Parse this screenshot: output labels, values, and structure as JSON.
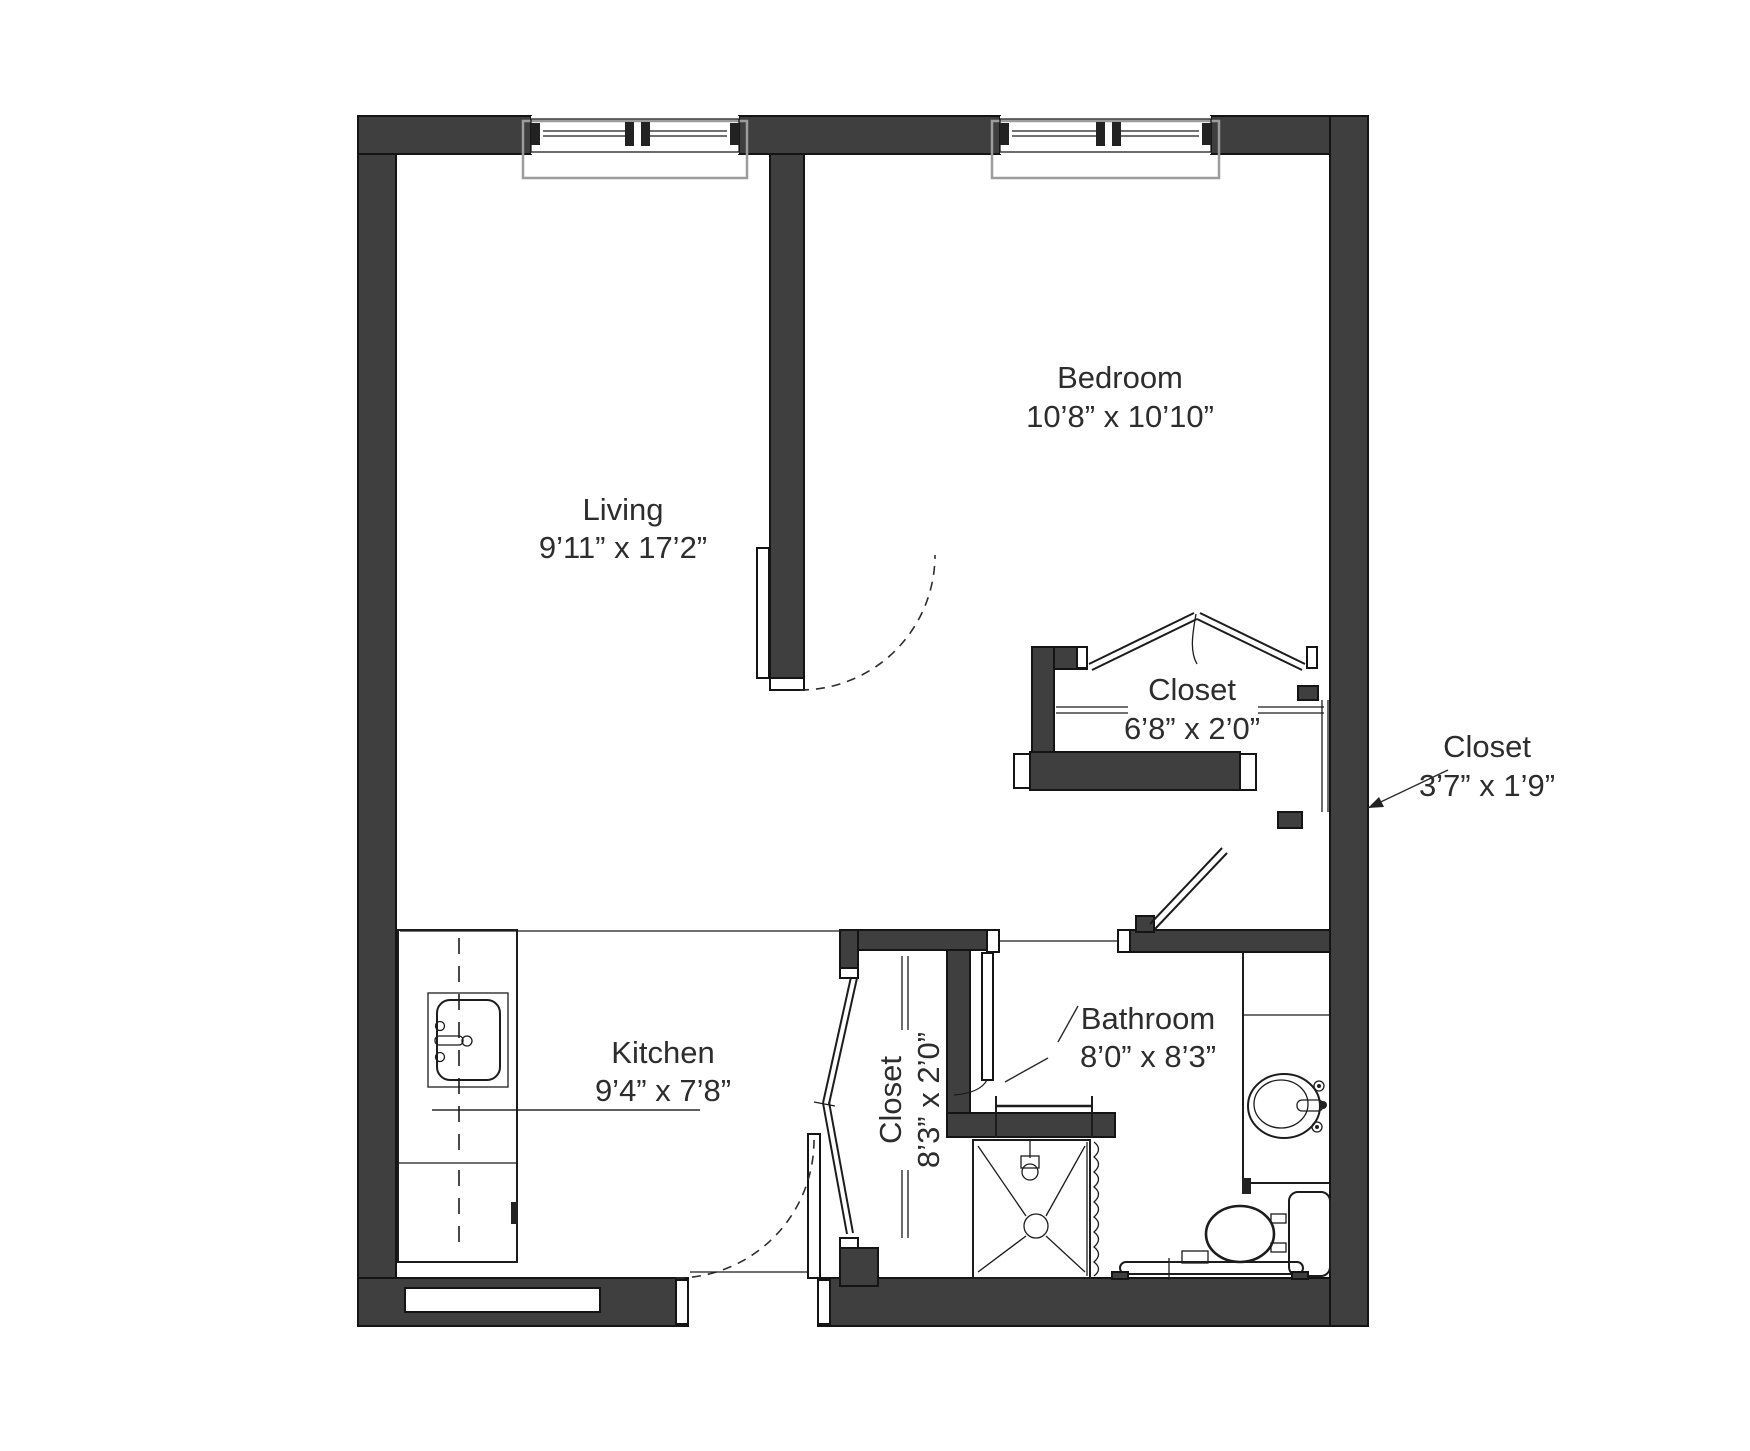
{
  "meta": {
    "background": "#ffffff",
    "wall_color": "#3f3f3f",
    "line_color": "#1c1c1c",
    "window_casing_color": "#9c9c9c",
    "text_color": "#2d2d2d"
  },
  "rooms": {
    "living": {
      "label": "Living",
      "dims": "9’11” x 17’2”"
    },
    "bedroom": {
      "label": "Bedroom",
      "dims": "10’8” x 10’10”"
    },
    "bedroom_closet": {
      "label": "Closet",
      "dims": "6’8” x 2’0”"
    },
    "hall_closet": {
      "label": "Closet",
      "dims": "3’7” x 1’9”"
    },
    "kitchen": {
      "label": "Kitchen",
      "dims": "9’4” x 7’8”"
    },
    "kitchen_closet": {
      "label": "Closet",
      "dims": "8’3” x 2’0”"
    },
    "bathroom": {
      "label": "Bathroom",
      "dims": "8’0” x 8’3”"
    }
  }
}
